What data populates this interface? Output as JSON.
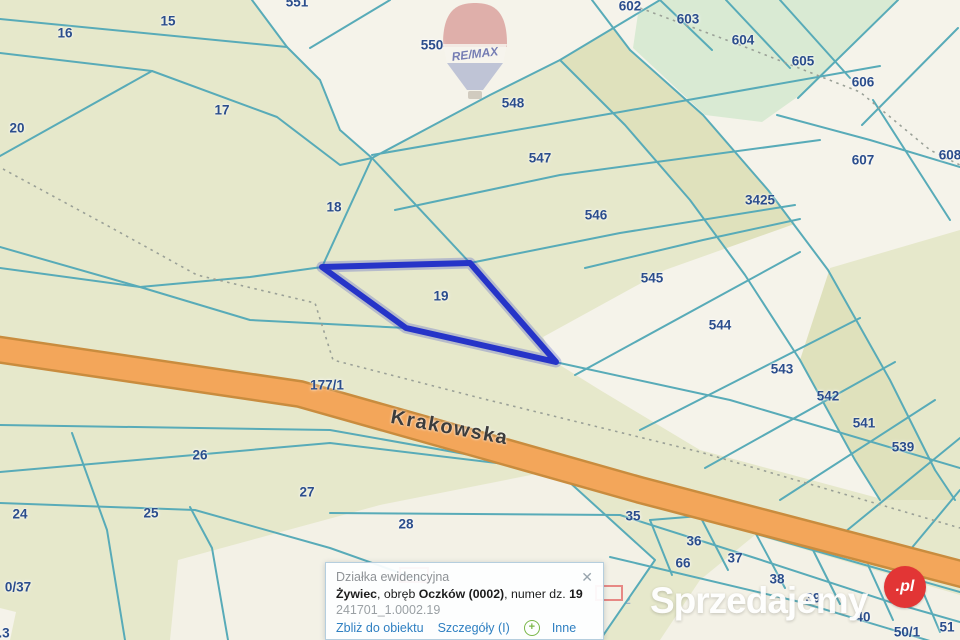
{
  "map": {
    "road_label": "Krakowska",
    "highlighted_parcel": "19",
    "parcel_labels": [
      {
        "t": "16",
        "x": 65,
        "y": 33
      },
      {
        "t": "15",
        "x": 168,
        "y": 21
      },
      {
        "t": "551",
        "x": 297,
        "y": 2
      },
      {
        "t": "17",
        "x": 222,
        "y": 110
      },
      {
        "t": "20",
        "x": 17,
        "y": 128
      },
      {
        "t": "18",
        "x": 334,
        "y": 207
      },
      {
        "t": "550",
        "x": 432,
        "y": 45
      },
      {
        "t": "548",
        "x": 513,
        "y": 103
      },
      {
        "t": "547",
        "x": 540,
        "y": 158
      },
      {
        "t": "546",
        "x": 596,
        "y": 215
      },
      {
        "t": "19",
        "x": 441,
        "y": 296
      },
      {
        "t": "545",
        "x": 652,
        "y": 278
      },
      {
        "t": "544",
        "x": 720,
        "y": 325
      },
      {
        "t": "543",
        "x": 782,
        "y": 369
      },
      {
        "t": "542",
        "x": 828,
        "y": 396
      },
      {
        "t": "541",
        "x": 864,
        "y": 423
      },
      {
        "t": "539",
        "x": 903,
        "y": 447
      },
      {
        "t": "602",
        "x": 630,
        "y": 6
      },
      {
        "t": "603",
        "x": 688,
        "y": 19
      },
      {
        "t": "604",
        "x": 743,
        "y": 40
      },
      {
        "t": "605",
        "x": 803,
        "y": 61
      },
      {
        "t": "606",
        "x": 863,
        "y": 82
      },
      {
        "t": "607",
        "x": 863,
        "y": 160
      },
      {
        "t": "608",
        "x": 950,
        "y": 155
      },
      {
        "t": "3425",
        "x": 760,
        "y": 200
      },
      {
        "t": "177/1",
        "x": 327,
        "y": 385
      },
      {
        "t": "26",
        "x": 200,
        "y": 455
      },
      {
        "t": "27",
        "x": 307,
        "y": 492
      },
      {
        "t": "28",
        "x": 406,
        "y": 524
      },
      {
        "t": "24",
        "x": 20,
        "y": 514
      },
      {
        "t": "25",
        "x": 151,
        "y": 513
      },
      {
        "t": "35",
        "x": 633,
        "y": 516
      },
      {
        "t": "36",
        "x": 694,
        "y": 541
      },
      {
        "t": "66",
        "x": 683,
        "y": 563
      },
      {
        "t": "37",
        "x": 735,
        "y": 558
      },
      {
        "t": "38",
        "x": 777,
        "y": 579
      },
      {
        "t": "39",
        "x": 813,
        "y": 598
      },
      {
        "t": "40",
        "x": 863,
        "y": 617
      },
      {
        "t": "50/1",
        "x": 907,
        "y": 632
      },
      {
        "t": "51",
        "x": 947,
        "y": 627
      },
      {
        "t": "0/37",
        "x": 18,
        "y": 587
      },
      {
        "t": ".3",
        "x": 4,
        "y": 633
      }
    ],
    "ghost_labels": [
      {
        "t": "31/1",
        "x": 452,
        "y": 578
      },
      {
        "t": "51/2",
        "x": 620,
        "y": 601
      }
    ],
    "colors": {
      "background_olive": "#e6e8cb",
      "parcel_cream": "#f5f3ea",
      "parcel_green": "#d9ead3",
      "strip_khaki": "#dfe1bc",
      "boundary_teal": "#58abb8",
      "road_orange": "#f3a65a",
      "road_casing": "#c98c3e",
      "highlight_blue": "#2634c8",
      "label_blue": "#2b4d8c",
      "marker_red": "#e05050"
    }
  },
  "balloon": {
    "brand": "RE/MAX"
  },
  "popup": {
    "title": "Działka ewidencyjna",
    "close_icon": "✕",
    "location_bold": "Żywiec",
    "seg_obreb": ", obręb ",
    "obreb_bold": "Oczków (0002)",
    "seg_numer": ", numer dz. ",
    "parcel_bold": "19",
    "code": "241701_1.0002.19",
    "plus_icon": "+",
    "links": {
      "zoom_to": "Zbliż do obiektu",
      "details": "Szczegóły (I)",
      "more": "Inne"
    }
  },
  "watermark": {
    "text": "Sprzedajemy",
    "badge": ".pl"
  }
}
